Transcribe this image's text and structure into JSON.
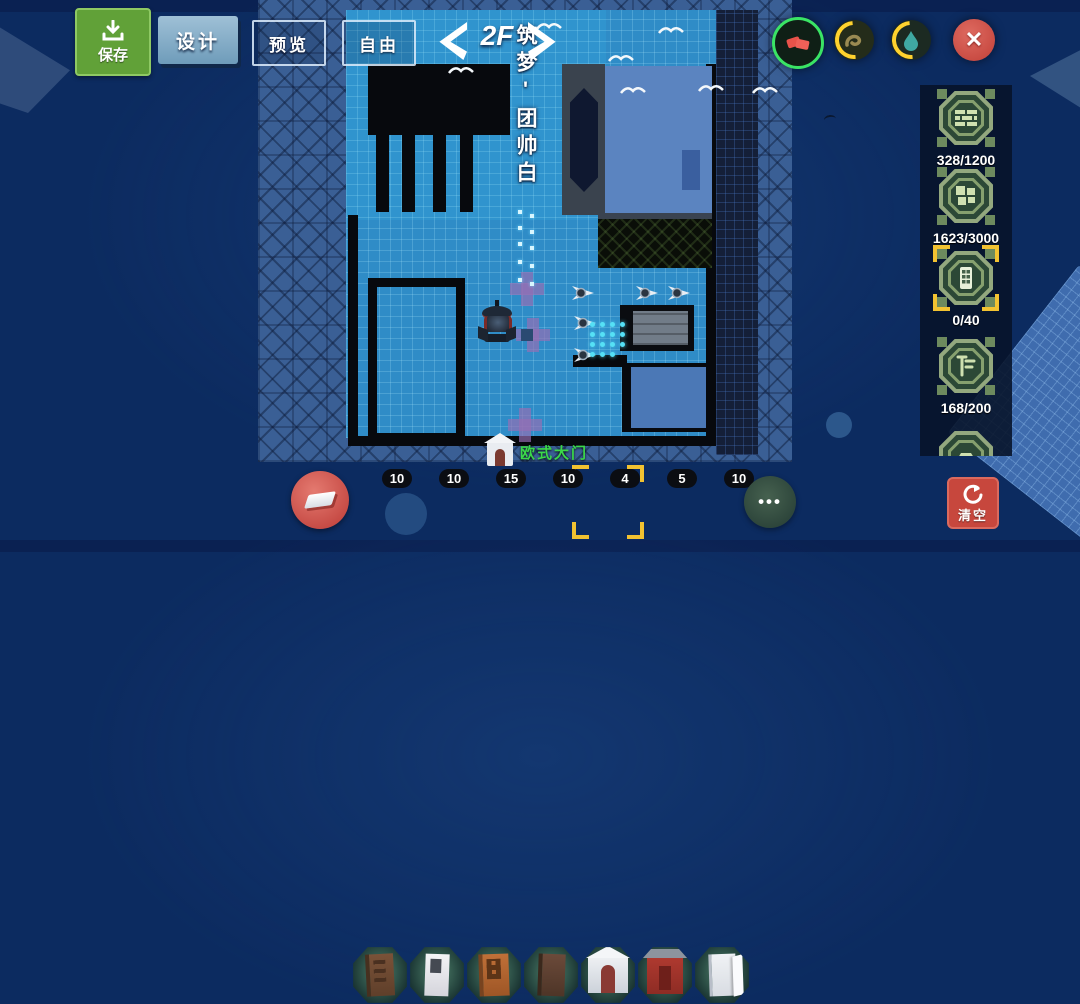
{
  "toolbar": {
    "save_label": "保存",
    "design_label": "设计",
    "preview_label": "预览",
    "free_label": "自由",
    "floor_label": "2F"
  },
  "map": {
    "sign_text": "筑梦'团帅白",
    "gate_label": "欧式大门"
  },
  "resource_panel": {
    "items": [
      {
        "icon": "brick-wall",
        "count": "328/1200"
      },
      {
        "icon": "floor-tile",
        "count": "1623/3000"
      },
      {
        "icon": "door-window",
        "count": "0/40",
        "selected": true
      },
      {
        "icon": "furniture",
        "count": "168/200"
      }
    ]
  },
  "hotbar": {
    "items": [
      {
        "name": "brown-door",
        "count": "10"
      },
      {
        "name": "white-door",
        "count": "10"
      },
      {
        "name": "orange-door",
        "count": "15"
      },
      {
        "name": "dark-brown-door",
        "count": "10"
      },
      {
        "name": "european-gate",
        "count": "4",
        "selected": true
      },
      {
        "name": "red-gate",
        "count": "5"
      },
      {
        "name": "white-open-door",
        "count": "10"
      }
    ],
    "more_label": "•••"
  },
  "actions": {
    "clear_label": "清空"
  },
  "colors": {
    "selection_yellow": "#f2c231",
    "active_green_ring": "#3ae465",
    "floor_blue": "#2f8cc7",
    "gate_label_green": "#3bd84a",
    "save_green": "#61a138",
    "danger_red": "#c7473d"
  }
}
